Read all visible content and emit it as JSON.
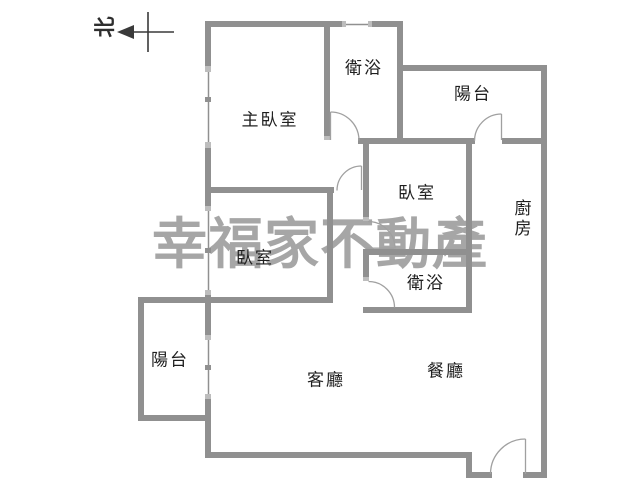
{
  "compass": {
    "label": "北"
  },
  "watermark": {
    "text": "幸福家不動產"
  },
  "rooms": [
    {
      "id": "master-bedroom",
      "label": "主臥室"
    },
    {
      "id": "bathroom-upper",
      "label": "衛浴"
    },
    {
      "id": "balcony-upper",
      "label": "陽台"
    },
    {
      "id": "bedroom-right",
      "label": "臥室"
    },
    {
      "id": "kitchen",
      "label": "廚房"
    },
    {
      "id": "bathroom-lower",
      "label": "衛浴"
    },
    {
      "id": "bedroom-left",
      "label": "臥室"
    },
    {
      "id": "balcony-lower",
      "label": "陽台"
    },
    {
      "id": "living-room",
      "label": "客廳"
    },
    {
      "id": "dining-room",
      "label": "餐廳"
    }
  ],
  "colors": {
    "background": "#ffffff",
    "wall": "#909090",
    "wall_cap": "#bdbdbd",
    "window_line": "#909090",
    "door_arc": "#a0a0a0",
    "label_text": "#1f1f1f",
    "watermark_text": "#a6a6a6",
    "compass": "#3a3a3a"
  }
}
